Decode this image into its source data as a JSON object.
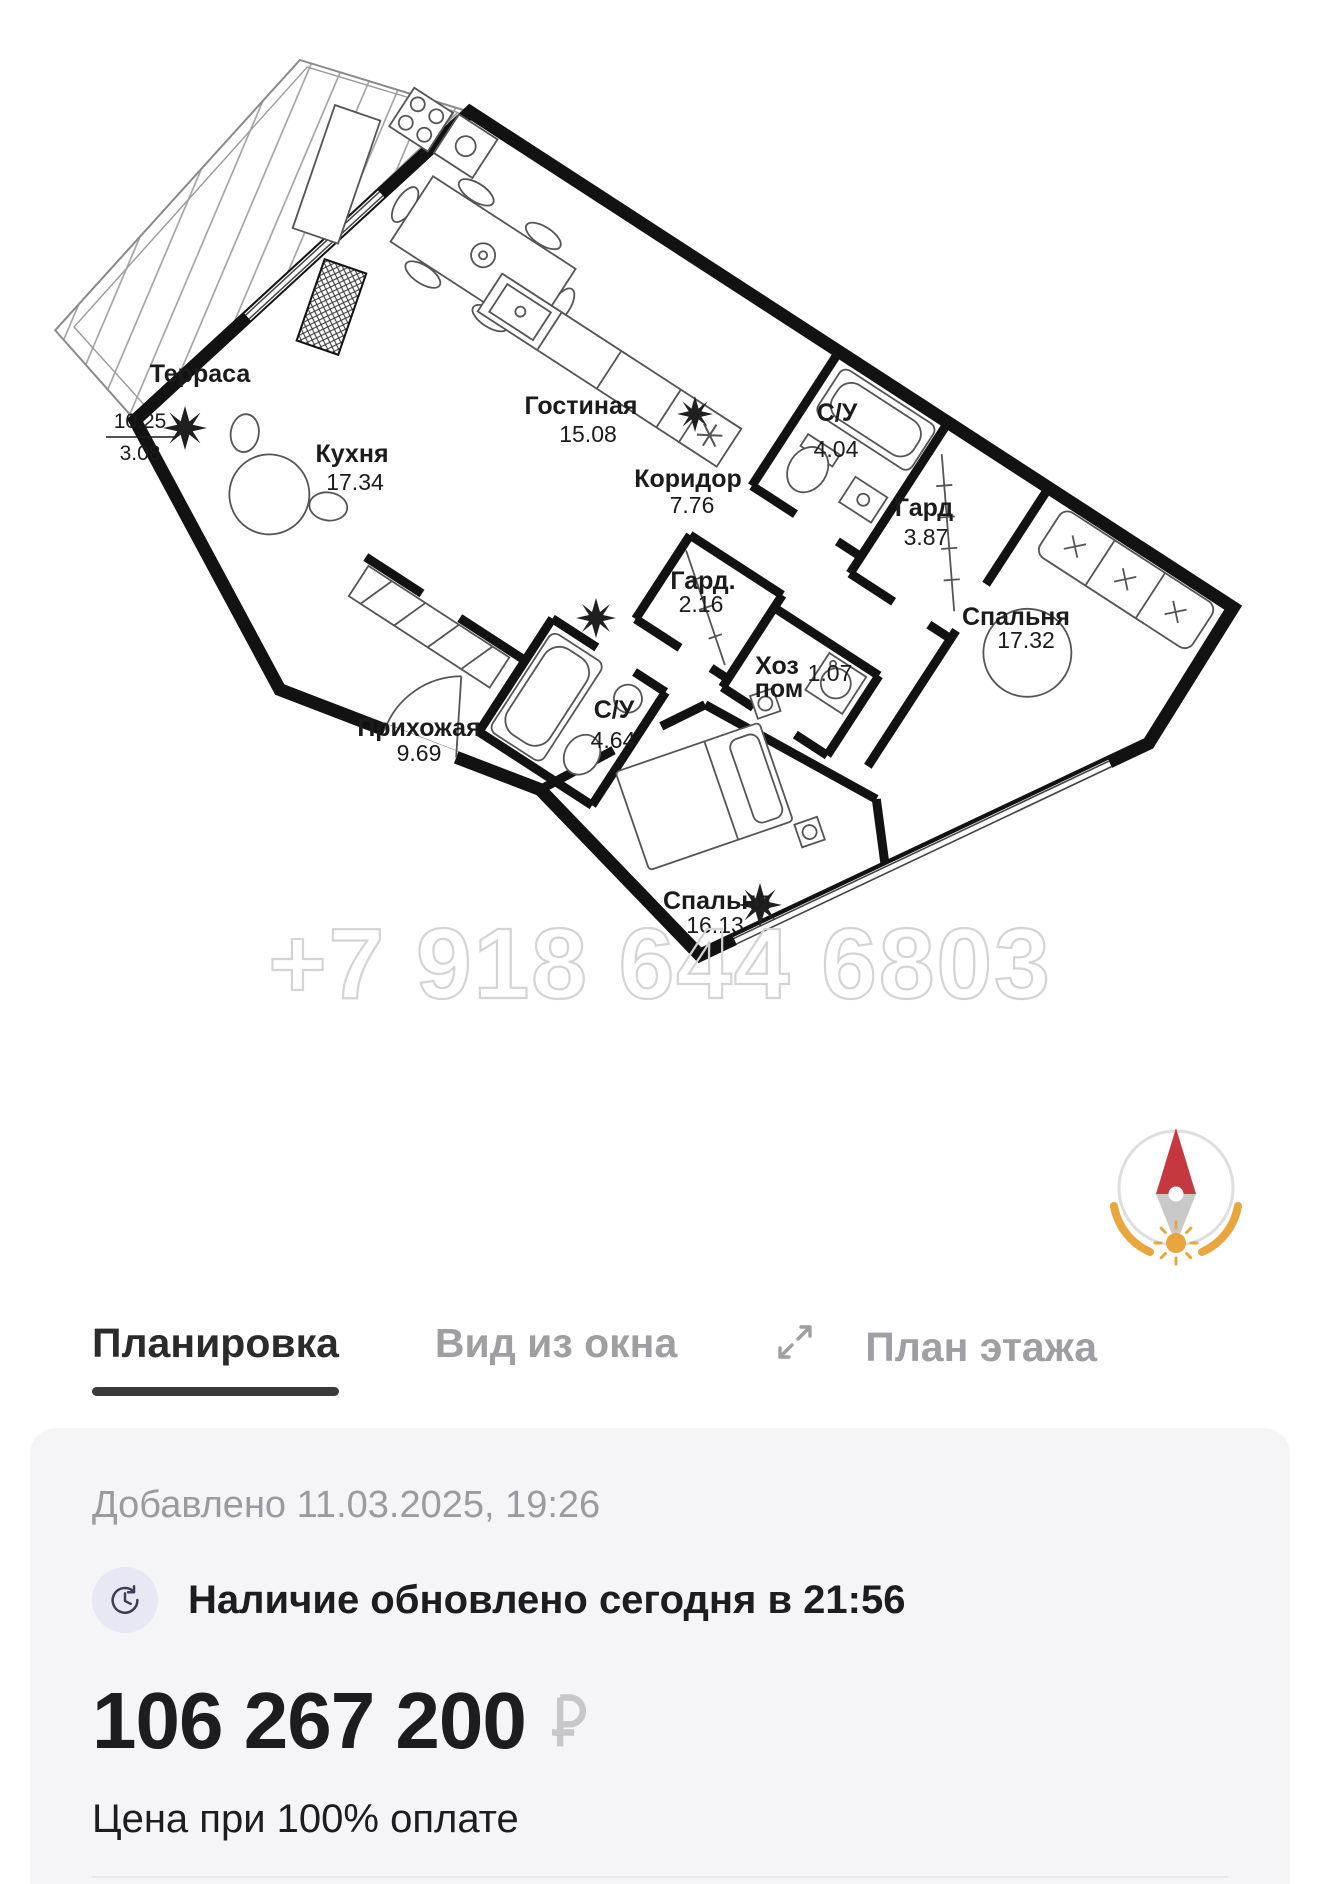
{
  "plan": {
    "watermark": "+7 918 644 6803",
    "terrace": {
      "name": "Терраса",
      "area_numerator": "10.25",
      "area_denominator": "3.08"
    },
    "rooms": [
      {
        "name": "Кухня",
        "area": "17.34"
      },
      {
        "name": "Гостиная",
        "area": "15.08"
      },
      {
        "name": "Коридор",
        "area": "7.76"
      },
      {
        "name": "С/У",
        "area": "4.04"
      },
      {
        "name": "Гард",
        "area": "3.87"
      },
      {
        "name": "Спальня",
        "area": "17.32"
      },
      {
        "name": "Гард.",
        "area": "2.16"
      },
      {
        "name": "Хоз",
        "name2": "пом",
        "area": "1.07"
      },
      {
        "name": "С/У",
        "area": "4.64"
      },
      {
        "name": "Прихожая",
        "area": "9.69"
      },
      {
        "name": "Спальня",
        "area": "16.13"
      }
    ]
  },
  "tabs": [
    {
      "label": "Планировка",
      "active": true
    },
    {
      "label": "Вид из окна",
      "active": false
    },
    {
      "label": "План этажа",
      "active": false,
      "icon": "expand-icon"
    }
  ],
  "card": {
    "added": "Добавлено 11.03.2025, 19:26",
    "availability": "Наличие обновлено сегодня в 21:56",
    "price": "106 267 200",
    "currency": "₽",
    "price_note": "Цена при 100% оплате"
  },
  "colors": {
    "wall": "#121212",
    "compass_accent": "#e9a63c",
    "needle_red": "#c5383f",
    "tab_active": "#2b2b2b",
    "tab_inactive": "#9e9ea3",
    "card_bg": "#f5f5f7"
  }
}
